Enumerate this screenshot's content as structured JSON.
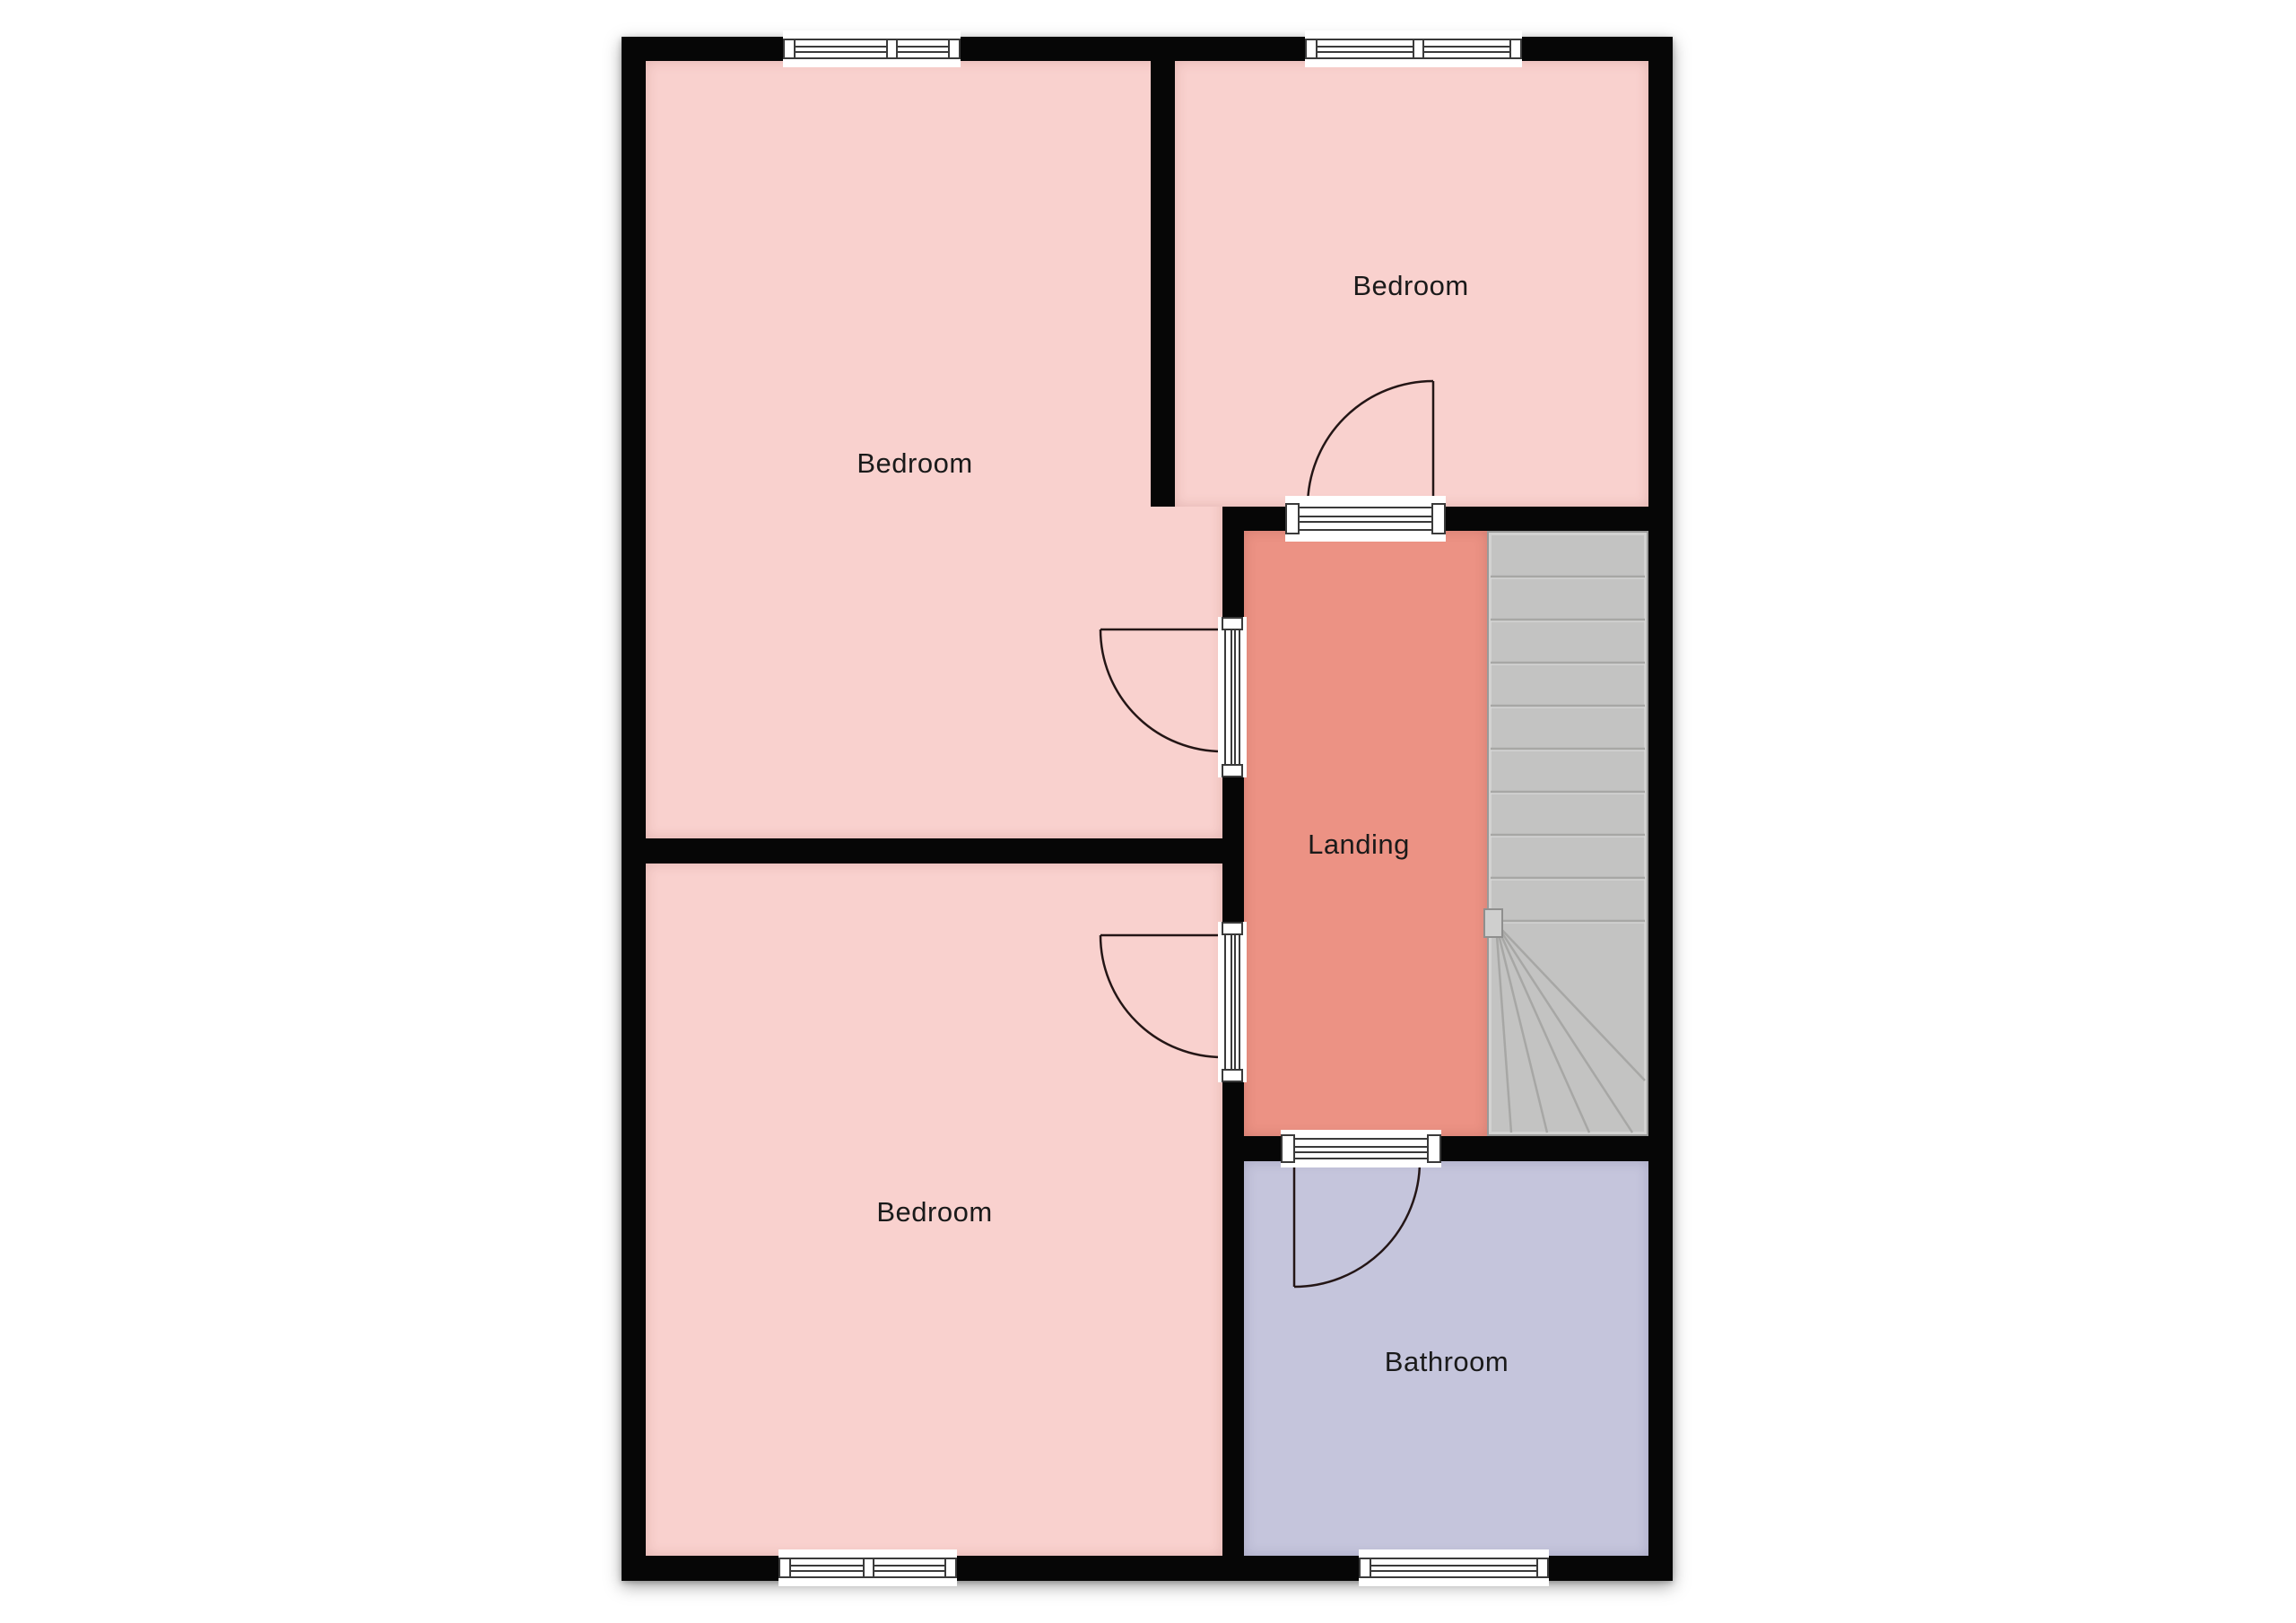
{
  "diagram_type": "floor-plan",
  "rooms": {
    "bedroom_top_left": {
      "label": "Bedroom"
    },
    "bedroom_top_right": {
      "label": "Bedroom"
    },
    "bedroom_bottom_left": {
      "label": "Bedroom"
    },
    "landing": {
      "label": "Landing"
    },
    "bathroom": {
      "label": "Bathroom"
    },
    "stairs": {
      "label": ""
    }
  },
  "colors": {
    "wall": "#060606",
    "bedroom_fill": "#f9d1ce",
    "landing_fill": "#ec9284",
    "bathroom_fill": "#c5c5dc",
    "stairs_fill": "#c3c3c2",
    "stair_line": "#a7a7a5",
    "symbol_line": "#3a3a3a",
    "door_arc": "#241616",
    "label_text": "#1a1a1a",
    "background": "#ffffff"
  },
  "features": {
    "windows": 4,
    "doors": 4,
    "staircase": "straight flight with bottom winder"
  }
}
